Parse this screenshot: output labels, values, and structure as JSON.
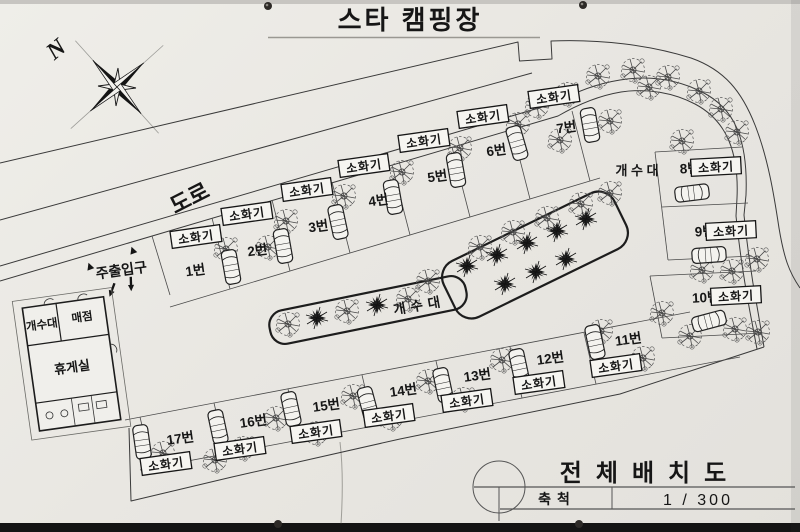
{
  "header": {
    "title": "스타 캠핑장"
  },
  "compass": {
    "label": "N"
  },
  "map": {
    "road_label": "도로",
    "entrance_label": "주출입구",
    "sink_center_label": "개수대",
    "sink_upper_label": "개 수 대",
    "extinguisher_label": "소화기",
    "sites": [
      "1번",
      "2번",
      "3번",
      "4번",
      "5번",
      "6번",
      "7번",
      "8번",
      "9번",
      "10번",
      "11번",
      "12번",
      "13번",
      "14번",
      "15번",
      "16번",
      "17번"
    ]
  },
  "building": {
    "sink": "개수대",
    "store": "매점",
    "lounge": "휴게실"
  },
  "titleblock": {
    "title": "전체배치도",
    "scale_label": "축척",
    "scale_value": "1  /  300"
  },
  "colors": {
    "paper": "#e9e7e2",
    "ink": "#1a1a1a",
    "line": "#2b2b2b"
  }
}
